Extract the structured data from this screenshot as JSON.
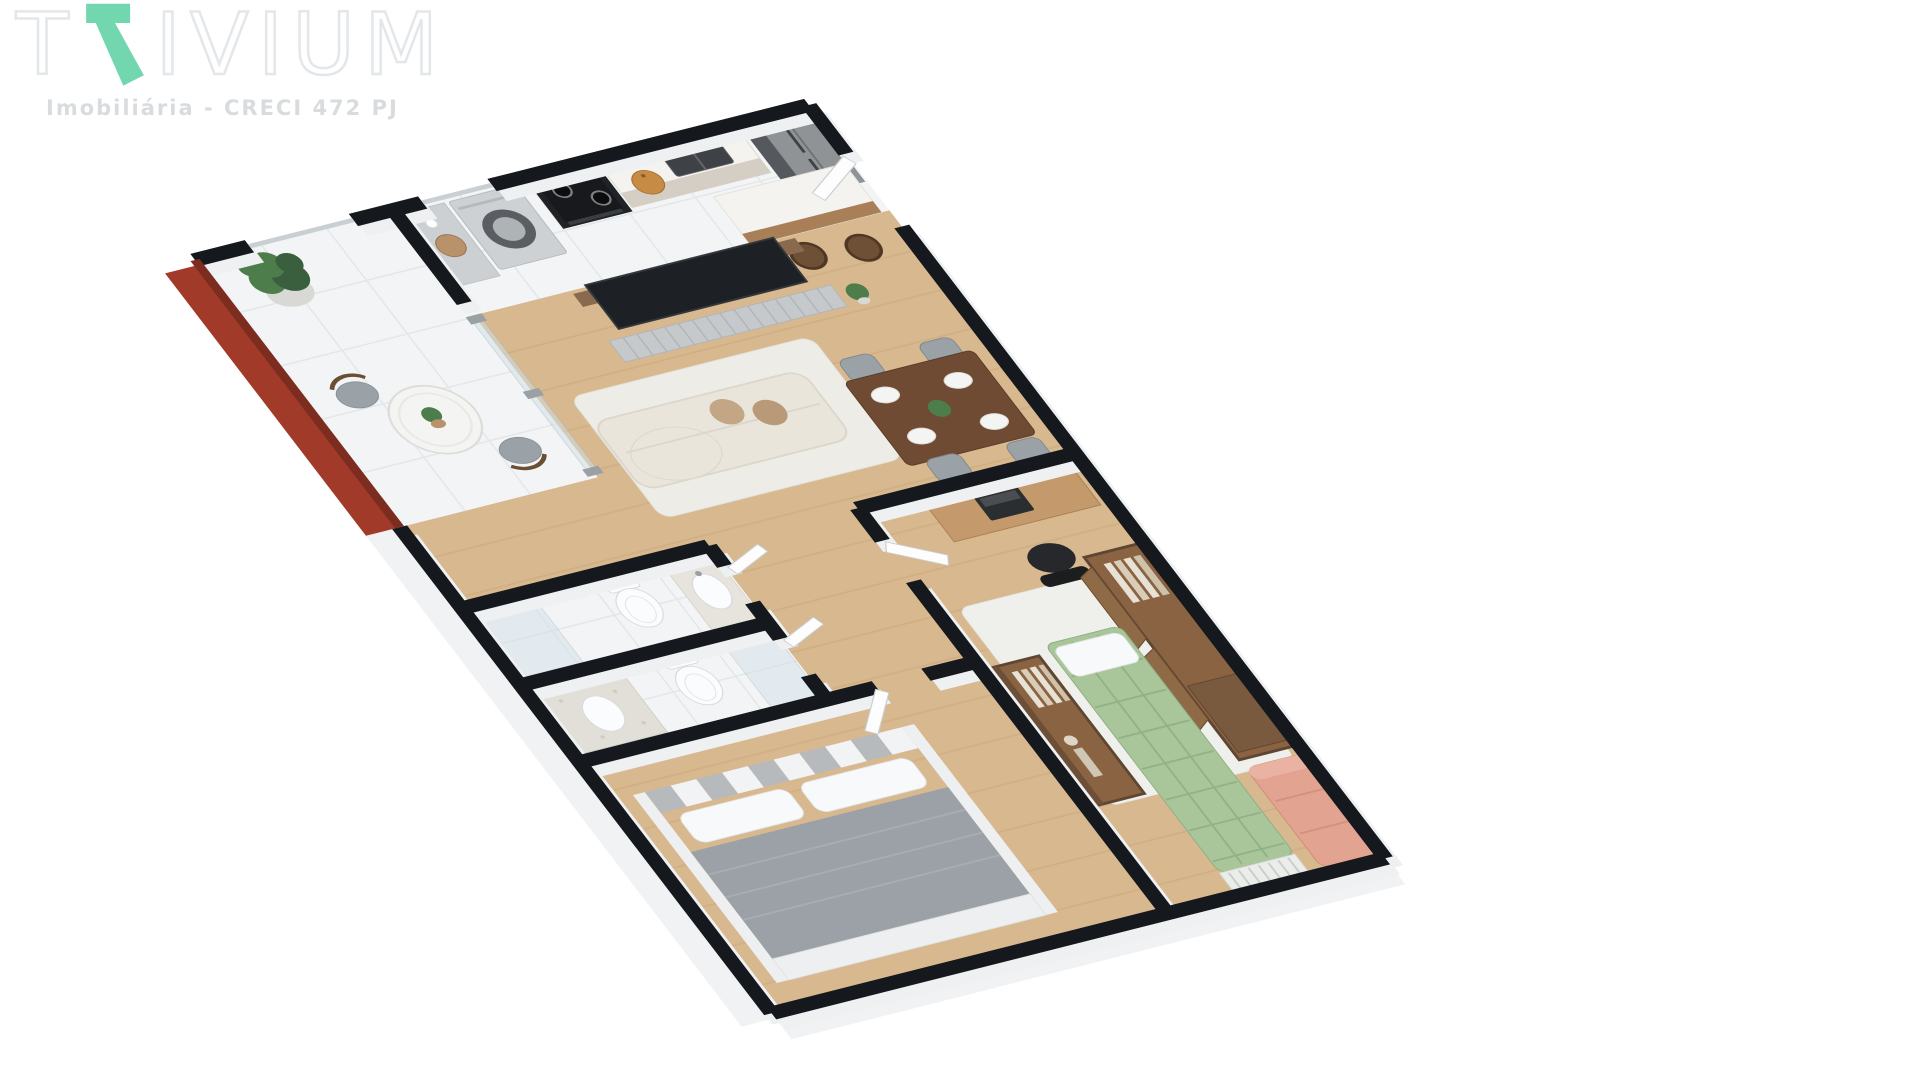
{
  "brand": {
    "name": "TRIVIUM",
    "name_prefix": "T",
    "name_suffix": "IVIUM",
    "accent_letter": "R",
    "subtitle": "Imobiliária - CRECI 472 PJ"
  },
  "colors": {
    "background": "#ffffff",
    "accent": "#72d6ae",
    "logo-outline": "#e4e7e9",
    "subtitle": "#d9dcde",
    "wall": "#15181d",
    "wall-face": "#eef0f2",
    "balcony-wall": "#a23a2a",
    "balcony-wall-edge": "#7c2d20",
    "plinth": "#f1f2f3",
    "wood-floor": "#d8b88f",
    "plank": "#c9a77a",
    "tile": "#f2f4f5",
    "tile-line": "#e2e6e8",
    "counter-beige": "#d5cec4",
    "counter-top": "#f5f3ef",
    "sink-dark": "#3e4246",
    "steel": "#9aa0a4",
    "fridge-body": "#55585c",
    "fridge-front": "#8f9396",
    "stove-black": "#202326",
    "appliance-silver": "#ced1d3",
    "washer-door": "#5a5e62",
    "island-top": "#f4f3f0",
    "island-wood": "#a97f57",
    "stool": "#6e5036",
    "tv-screen": "#1d2024",
    "tv-wood": "#8a6a4e",
    "credenza": "#c6c9cb",
    "sofa-cream": "#e9e5db",
    "pillow-tan": "#c3a685",
    "rug-light": "#edece6",
    "table-wood": "#6e4b32",
    "chair-gray": "#9aa1a7",
    "plate-white": "#f4f4f2",
    "plant-green": "#4e7d4c",
    "plant-dark": "#3a5f3e",
    "pot-gray": "#d8d8d4",
    "pot-brown": "#b8926a",
    "toilet-white": "#fbfcfd",
    "fixture-line": "#d7dadc",
    "pebble": "#e2dfd8",
    "glass-fill": "#cfe0e8",
    "glass-frame": "#aeb8bd",
    "door-leaf": "#fdfdfd",
    "door-edge": "#c9cdd0",
    "bed-blanket": "#9ba1a6",
    "bed-pillow": "#f8f9fa",
    "bed-frame": "#edeff0",
    "headboard-a": "#b6babd",
    "headboard-b": "#f2f3f4",
    "wardrobe-frame": "#5f4632",
    "wardrobe-inside": "#8a6342",
    "wardrobe-door": "#8f6a47",
    "clothes-light": "#e8e2d6",
    "desk-wood": "#c49a6c",
    "laptop-dark": "#2b2e31",
    "chair-black": "#26282b",
    "daybed-green": "#a9c69b",
    "daybed-line": "#92b285",
    "bench-white": "#eaedea",
    "salmon": "#e2a391",
    "salmon-line": "#cf8d7a"
  },
  "scene": {
    "type": "3d-floor-plan",
    "view": "isometric",
    "rooms": [
      {
        "name": "balcony",
        "floor": "white-tile",
        "feature_wall": "red",
        "furniture": [
          "round-bistro-table",
          "two-chairs",
          "tall-potted-plant",
          "table-plant"
        ]
      },
      {
        "name": "laundry",
        "floor": "white-tile",
        "furniture": [
          "laundry-counter",
          "basket",
          "front-load-washer"
        ]
      },
      {
        "name": "kitchen",
        "floor": "white-tile",
        "furniture": [
          "stove",
          "counter-with-sink",
          "cutting-board",
          "refrigerator",
          "island-breakfast-bar",
          "two-bar-stools"
        ]
      },
      {
        "name": "living-room",
        "floor": "wood",
        "furniture": [
          "tv-panel",
          "tv",
          "credenza",
          "chaise-sofa",
          "pillows",
          "rug",
          "small-plant"
        ]
      },
      {
        "name": "dining-area",
        "floor": "wood",
        "furniture": [
          "wood-table",
          "four-chairs",
          "four-place-settings",
          "centerpiece-plant"
        ]
      },
      {
        "name": "bathroom-1",
        "floor": "white-tile",
        "furniture": [
          "toilet",
          "sink-counter",
          "glass-shower"
        ]
      },
      {
        "name": "bathroom-2",
        "floor": "white-tile",
        "furniture": [
          "toilet",
          "pebble-counter-sink",
          "glass-shower"
        ]
      },
      {
        "name": "hallway",
        "floor": "wood",
        "furniture": []
      },
      {
        "name": "master-bedroom",
        "floor": "wood",
        "furniture": [
          "double-bed",
          "checkered-headboard",
          "pillows",
          "gray-blanket"
        ]
      },
      {
        "name": "second-bedroom-office",
        "floor": "wood",
        "furniture": [
          "desk",
          "laptop",
          "office-chair",
          "white-rug",
          "green-tufted-daybed",
          "slat-bench",
          "salmon-sofa",
          "open-wardrobe-with-clothes",
          "large-open-wardrobe"
        ]
      }
    ],
    "doors": [
      "entry-door",
      "bedroom2-door",
      "master-door",
      "bathroom1-door",
      "bathroom2-door"
    ],
    "windows": [
      "balcony-opening",
      "laundry-window",
      "balcony-glass-slider"
    ]
  }
}
